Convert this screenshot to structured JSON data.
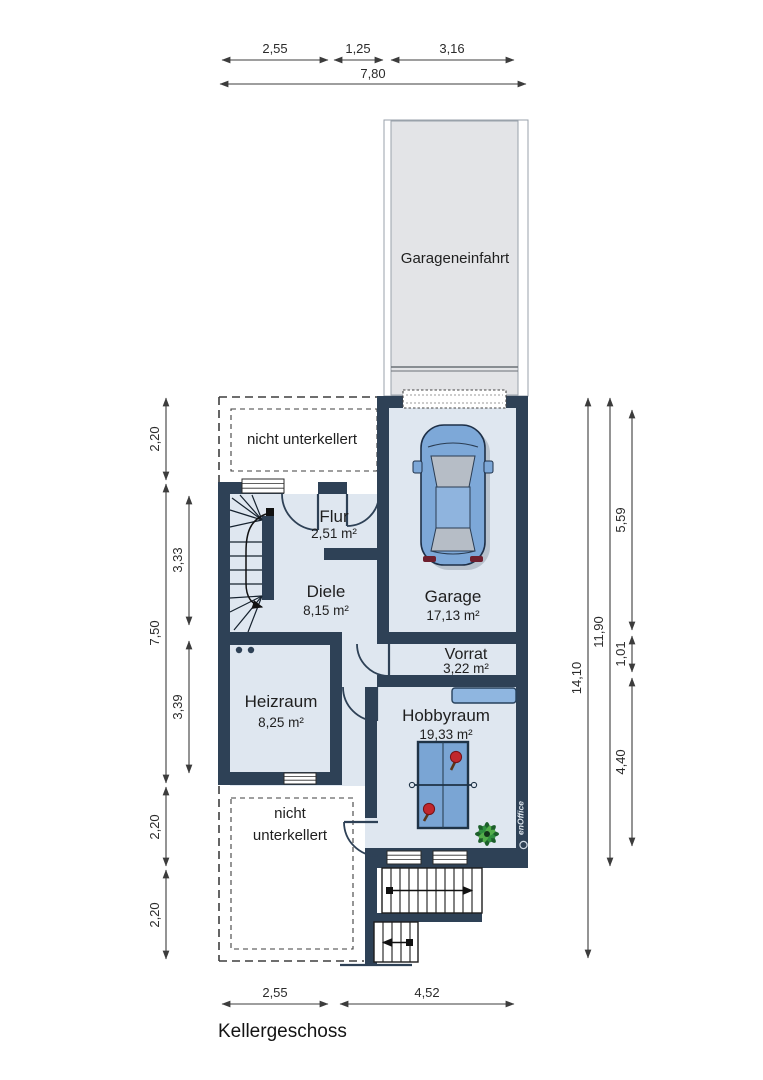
{
  "plan_title": "Kellergeschoss",
  "driveway": {
    "label": "Garageneinfahrt"
  },
  "areas": {
    "upper_no_basement": "nicht unterkellert",
    "lower_no_basement_line1": "nicht",
    "lower_no_basement_line2": "unterkellert"
  },
  "rooms": {
    "flur": {
      "name": "Flur",
      "area": "2,51 m²"
    },
    "diele": {
      "name": "Diele",
      "area": "8,15 m²"
    },
    "garage": {
      "name": "Garage",
      "area": "17,13 m²"
    },
    "vorrat": {
      "name": "Vorrat",
      "area": "3,22 m²"
    },
    "heizraum": {
      "name": "Heizraum",
      "area": "8,25 m²"
    },
    "hobbyraum": {
      "name": "Hobbyraum",
      "area": "19,33 m²"
    }
  },
  "dimensions": {
    "top_row": [
      "2,55",
      "1,25",
      "3,16"
    ],
    "top_total": "7,80",
    "left_outer": [
      "2,20",
      "7,50",
      "2,20",
      "2,20"
    ],
    "left_inner": [
      "3,33",
      "3,39"
    ],
    "right_outer_total": "14,10",
    "right_building": "11,90",
    "right_inner": [
      "5,59",
      "1,01",
      "4,40"
    ],
    "bottom_row": [
      "2,55",
      "4,52"
    ]
  },
  "branding": {
    "logo_text": "enOffice"
  },
  "colors": {
    "wall": "#2e4156",
    "floor": "#dfe7f0",
    "driveway": "#e3e4e7",
    "furniture_blue": "#7aa5d4",
    "car_blue": "#7da8d8",
    "paddle_red": "#c1272d",
    "plant_green": "#2f8f3f",
    "dimension_text": "#2b2b2b"
  }
}
